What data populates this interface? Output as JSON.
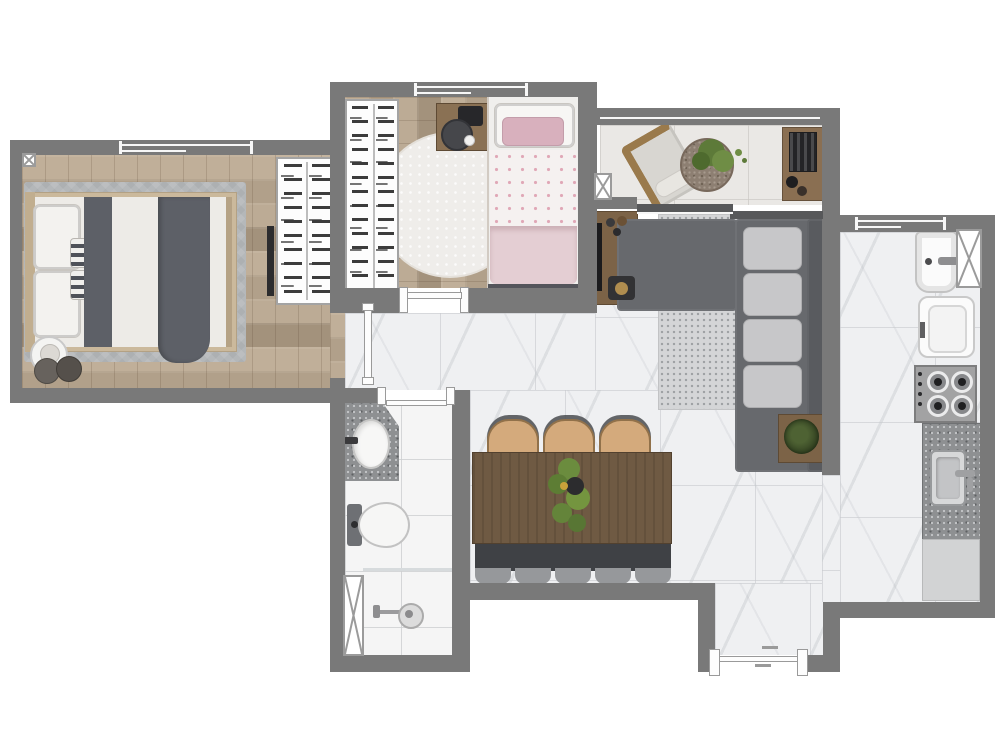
{
  "type": "floor-plan",
  "title": "apartment-floor-plan-top-view",
  "canvas": {
    "width": 1000,
    "height": 755
  },
  "palette": {
    "wall": "#797979",
    "wood": "#b7a68f",
    "marble": "#eff0f2",
    "balconyTile": "#eae8e5",
    "bathTile": "#f5f5f5",
    "rugBedroom": "#b4b7b9",
    "rugLiving": "#d4d5d7",
    "sofa": "#67696d",
    "sofaBack": "#595b5f",
    "pillow": "#c7c7c9",
    "woodFurniture": "#7c6347",
    "diningTable": "#6f5a43",
    "chairTan": "#d4aa7c",
    "benchDark": "#3f4145",
    "blanketGray": "#5d6067",
    "pinkDuvet": "#e4ced3",
    "pinkPillow": "#d8b0bd",
    "plantGreen": "#678b3e",
    "granite": "#8e9092",
    "applianceWhite": "#fbfbfb",
    "stoveSteel": "#a2a2a3"
  },
  "rooms": [
    {
      "id": "main-bedroom",
      "floor": "wood",
      "furniture": [
        "double-bed",
        "headboard",
        "pillows-2",
        "striped-cushions-2",
        "gray-runner",
        "gray-blanket",
        "area-rug",
        "round-side-table",
        "poufs-2",
        "open-wardrobe",
        "wall-tv-panel"
      ],
      "openings": [
        "sliding-window",
        "door"
      ]
    },
    {
      "id": "second-bedroom",
      "floor": "wood",
      "furniture": [
        "single-bed-pink",
        "white-pillow",
        "pink-pillow",
        "polka-dot-sheet",
        "pink-duvet",
        "round-fur-rug",
        "desk",
        "stool",
        "open-wardrobe"
      ],
      "openings": [
        "sliding-window",
        "door"
      ]
    },
    {
      "id": "balcony",
      "floor": "tile",
      "furniture": [
        "lounge-chair",
        "round-planter-table",
        "grill-cabinet"
      ],
      "openings": [
        "glass-railing",
        "sliding-glass-door"
      ]
    },
    {
      "id": "living-room",
      "floor": "marble",
      "furniture": [
        "l-shaped-sofa",
        "sofa-cushions-4",
        "dotted-rug",
        "tv-stand",
        "tv",
        "decor-candles",
        "decor-tray",
        "plant-side-table"
      ],
      "openings": []
    },
    {
      "id": "dining-area",
      "floor": "marble",
      "furniture": [
        "dining-table",
        "chairs-3",
        "bench",
        "bench-cushions-5",
        "plant-centerpiece"
      ],
      "openings": [
        "entry-door"
      ]
    },
    {
      "id": "kitchen",
      "floor": "marble",
      "furniture": [
        "laundry-sink",
        "washing-machine",
        "gas-cooktop",
        "granite-counter",
        "kitchen-sink",
        "base-cabinet"
      ],
      "openings": [
        "sliding-window",
        "ventilation-shaft"
      ]
    },
    {
      "id": "bathroom",
      "floor": "tile",
      "furniture": [
        "granite-vanity",
        "oval-basin",
        "toilet",
        "shower-area",
        "shower-glass-panel",
        "floor-drain"
      ],
      "openings": [
        "door"
      ]
    }
  ],
  "symbols": {
    "ventilation-shafts": 2,
    "corner-marker": 1,
    "shower-glass": 1,
    "windows": 3,
    "doors": 4,
    "sliding-doors": 1
  }
}
